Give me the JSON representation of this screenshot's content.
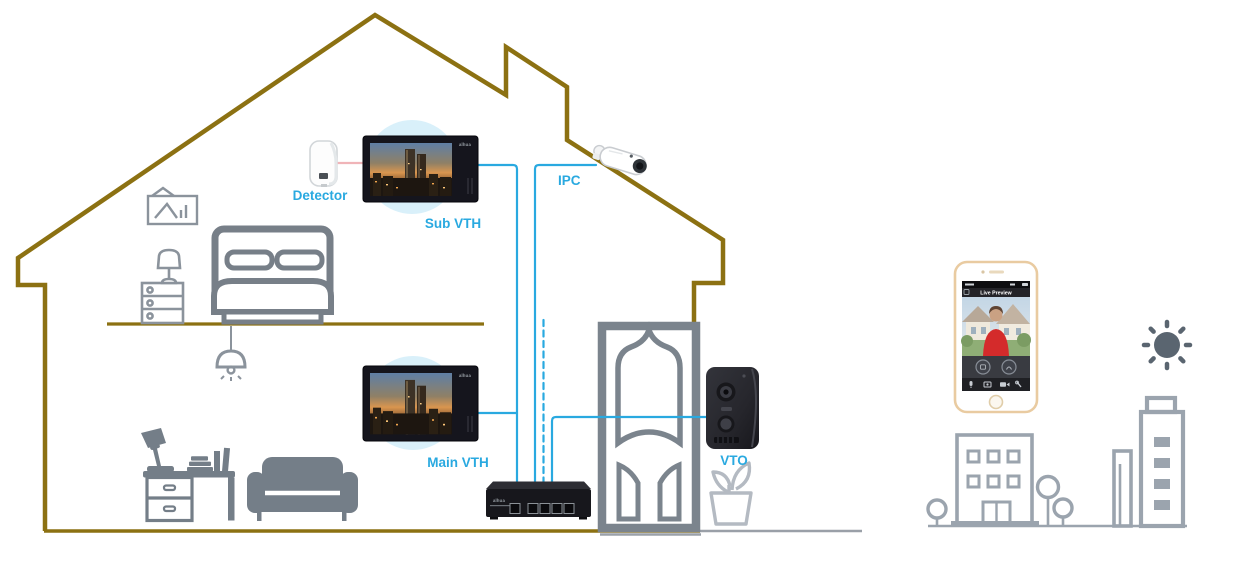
{
  "labels": {
    "detector": "Detector",
    "sub_vth": "Sub VTH",
    "ipc": "IPC",
    "main_vth": "Main VTH",
    "vto": "VTO"
  },
  "phone": {
    "title": "Live Preview"
  },
  "brand": {
    "device_logo": "alhua"
  },
  "colors": {
    "accent_blue": "#29a9e0",
    "roof_olive": "#8c7112",
    "furniture_gray": "#7b848d",
    "city_gray": "#9ba4ae",
    "detector_link_pink": "#f0b4b8",
    "halo_blue": "#d9f0fa"
  },
  "diagram": {
    "type": "smart-home-video-intercom-topology",
    "nodes": [
      {
        "id": "detector",
        "label": "Detector",
        "kind": "pir-motion-sensor"
      },
      {
        "id": "sub-vth",
        "label": "Sub VTH",
        "kind": "indoor-monitor"
      },
      {
        "id": "ipc",
        "label": "IPC",
        "kind": "bullet-network-camera"
      },
      {
        "id": "main-vth",
        "label": "Main VTH",
        "kind": "indoor-monitor"
      },
      {
        "id": "vto",
        "label": "VTO",
        "kind": "outdoor-door-station"
      },
      {
        "id": "switch",
        "label": "",
        "kind": "network-switch"
      },
      {
        "id": "phone",
        "label": "Live Preview",
        "kind": "smartphone-app"
      }
    ],
    "connections": [
      {
        "from": "detector",
        "to": "sub-vth",
        "style": "solid",
        "color": "pink"
      },
      {
        "from": "sub-vth",
        "to": "switch",
        "style": "solid",
        "color": "blue"
      },
      {
        "from": "main-vth",
        "to": "sub-vth-riser",
        "style": "solid",
        "color": "blue"
      },
      {
        "from": "ipc",
        "to": "switch",
        "style": "solid",
        "color": "blue"
      },
      {
        "from": "upstairs",
        "to": "switch",
        "style": "dashed",
        "color": "blue"
      },
      {
        "from": "vto",
        "to": "switch",
        "style": "solid",
        "color": "blue"
      }
    ]
  }
}
